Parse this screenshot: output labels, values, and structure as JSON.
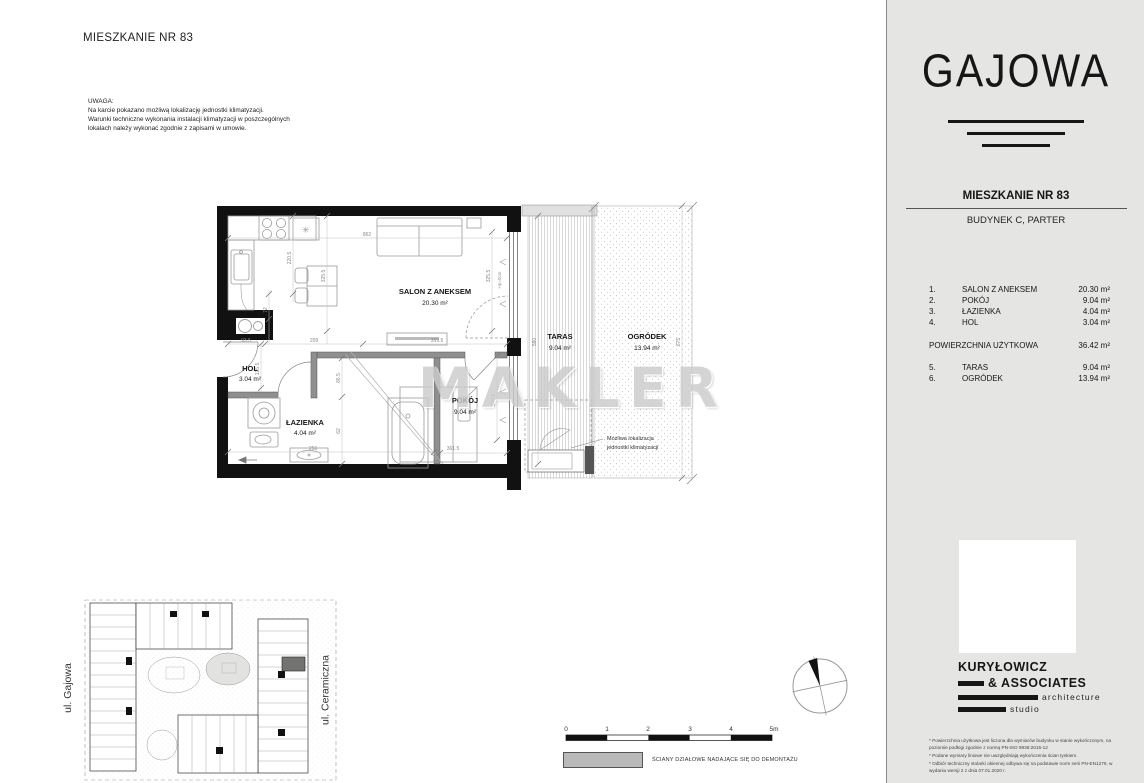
{
  "page": {
    "title": "MIESZKANIE NR 83",
    "notice_heading": "UWAGA:",
    "notice_line1": "Na karcie pokazano możliwą lokalizację jednostki klimatyzacji.",
    "notice_line2": "Warunki techniczne wykonania instalacji klimatyzacji w poszczególnych",
    "notice_line3": "lokalach należy wykonać zgodnie z zapisami w umowie.",
    "watermark": "MAKLER"
  },
  "plan": {
    "rooms": {
      "salon": {
        "name": "SALON Z ANEKSEM",
        "area": "20.30 m²"
      },
      "pokoj": {
        "name": "POKÓJ",
        "area": "9.04 m²"
      },
      "lazienka": {
        "name": "ŁAZIENKA",
        "area": "4.04 m²"
      },
      "hol": {
        "name": "HOL",
        "area": "3.04 m²"
      },
      "taras": {
        "name": "TARAS",
        "area": "9.04 m²"
      },
      "ogrodek": {
        "name": "OGRÓDEK",
        "area": "13.94 m²"
      }
    },
    "dims": {
      "d862": "862",
      "d2205": "220.5",
      "d72": "72",
      "d1255": "125.5",
      "d3255a": "325.5",
      "d3255b": "325.5",
      "d935": "93.5",
      "d209": "209",
      "d3595": "359.5",
      "d865": "86.5",
      "d62": "62",
      "d256": "256",
      "d3615": "361.5",
      "d2025": "202.5",
      "d580": "580",
      "d675": "675",
      "hp": "Hp=0cm"
    },
    "symbols": {
      "light": "✳"
    },
    "ac_note_line1": "Możliwa lokalizacja",
    "ac_note_line2": "jednostki klimatyzacji"
  },
  "site": {
    "street_left": "ul. Gajowa",
    "street_right": "ul. Ceramiczna"
  },
  "scalebar": {
    "t0": "0",
    "t1": "1",
    "t2": "2",
    "t3": "3",
    "t4": "4",
    "t5": "5m"
  },
  "legend": {
    "label": "ŚCIANY DZIAŁOWE NADAJĄCE SIĘ DO DEMONTAŻU"
  },
  "sidebar": {
    "brand": "GAJOWA",
    "apartment_title": "MIESZKANIE NR 83",
    "building": "BUDYNEK C, PARTER",
    "rows": [
      {
        "no": "1.",
        "name": "SALON Z ANEKSEM",
        "area": "20.30 m²"
      },
      {
        "no": "2.",
        "name": "POKÓJ",
        "area": "9.04 m²"
      },
      {
        "no": "3.",
        "name": "ŁAZIENKA",
        "area": "4.04 m²"
      },
      {
        "no": "4.",
        "name": "HOL",
        "area": "3.04 m²"
      }
    ],
    "total_label": "POWIERZCHNIA UŻYTKOWA",
    "total_area": "36.42 m²",
    "outdoor_rows": [
      {
        "no": "5.",
        "name": "TARAS",
        "area": "9.04 m²"
      },
      {
        "no": "6.",
        "name": "OGRÓDEK",
        "area": "13.94 m²"
      }
    ],
    "architect_line1": "KURYŁOWICZ",
    "architect_line2": "& ASSOCIATES",
    "architect_line3": "architecture",
    "architect_line4": "studio",
    "footnotes": [
      "* Powierzchnia użytkowa jest liczona dla wymiarów budynku w stanie wykończonym, na poziomie podłogi zgodnie z normą PN-ISO 9836:2015-12",
      "* Podane wymiary liniowe nie uwzględniają wykończenia ścian tynkiem.",
      "* Odbiór techniczny stolarki okiennej odbywa się na podstawie norm serii PN-EN1279, w wydaniu wersji 2 z dnia 07.01.2020 r."
    ]
  }
}
